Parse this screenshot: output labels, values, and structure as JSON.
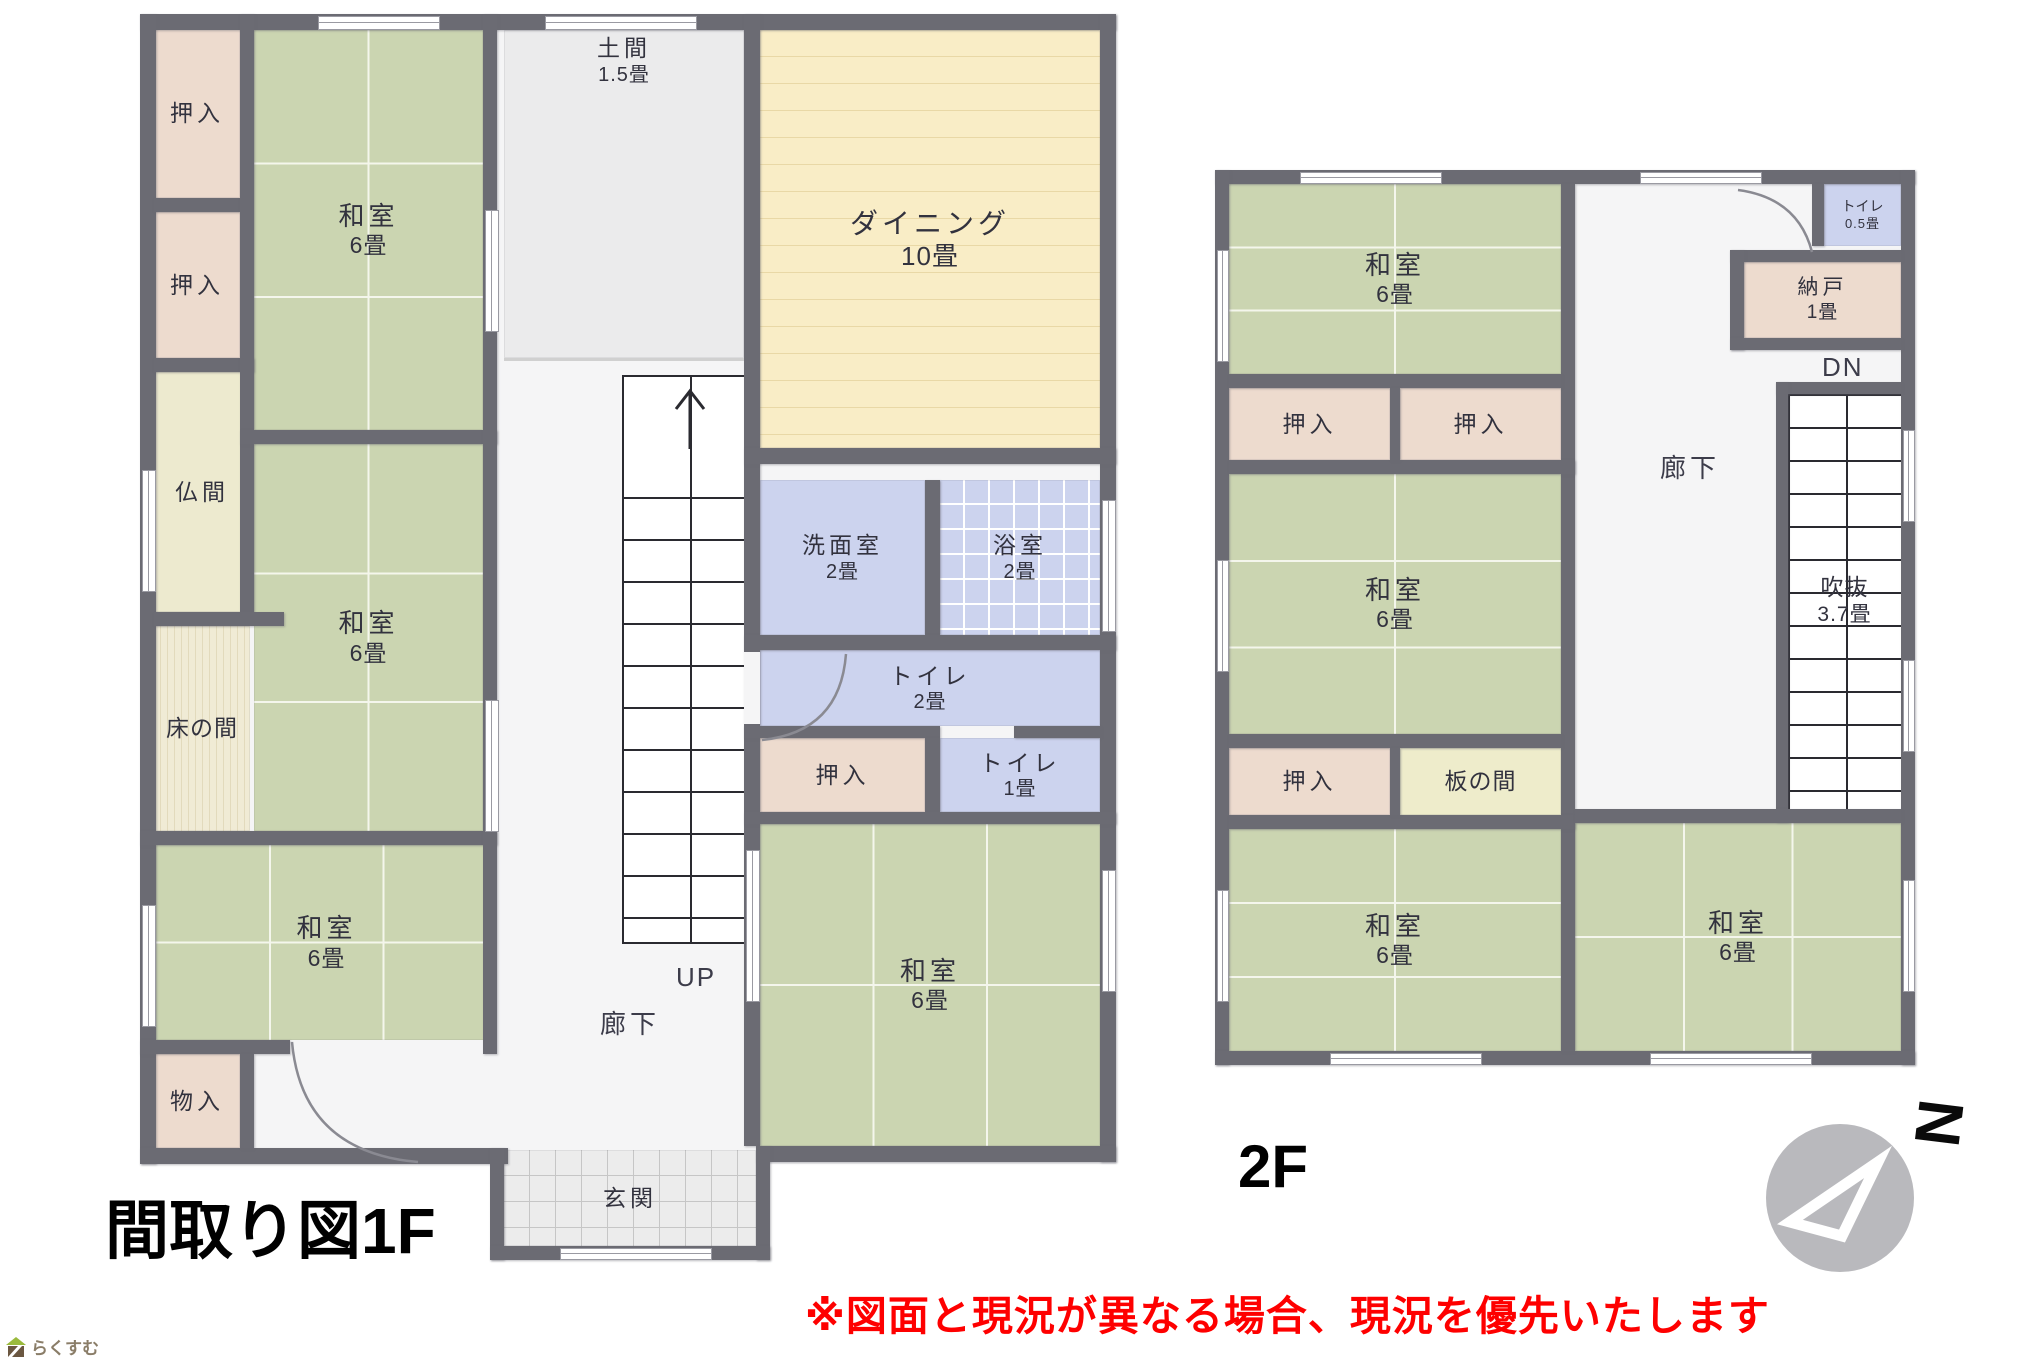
{
  "page": {
    "floor1_title": "間取り図1F",
    "floor2_title": "2F",
    "note": "※図面と現況が異なる場合、現況を優先いたします",
    "logo_text": "らくすむ",
    "compass_letter": "N"
  },
  "floor1": {
    "rooms": [
      {
        "name": "押入",
        "size": ""
      },
      {
        "name": "押入",
        "size": ""
      },
      {
        "name": "仏間",
        "size": ""
      },
      {
        "name": "床の間",
        "size": ""
      },
      {
        "name": "和室",
        "size": "6畳"
      },
      {
        "name": "和室",
        "size": "6畳"
      },
      {
        "name": "和室",
        "size": "6畳"
      },
      {
        "name": "物入",
        "size": ""
      },
      {
        "name": "土間",
        "size": "1.5畳"
      },
      {
        "name": "ダイニング",
        "size": "10畳"
      },
      {
        "name": "洗面室",
        "size": "2畳"
      },
      {
        "name": "浴室",
        "size": "2畳"
      },
      {
        "name": "トイレ",
        "size": "2畳"
      },
      {
        "name": "押入",
        "size": ""
      },
      {
        "name": "トイレ",
        "size": "1畳"
      },
      {
        "name": "和室",
        "size": "6畳"
      },
      {
        "name": "玄関",
        "size": ""
      }
    ],
    "corridor_label": "廊下",
    "up_label": "UP"
  },
  "floor2": {
    "rooms": [
      {
        "name": "和室",
        "size": "6畳"
      },
      {
        "name": "押入",
        "size": ""
      },
      {
        "name": "押入",
        "size": ""
      },
      {
        "name": "和室",
        "size": "6畳"
      },
      {
        "name": "押入",
        "size": ""
      },
      {
        "name": "板の間",
        "size": ""
      },
      {
        "name": "和室",
        "size": "6畳"
      },
      {
        "name": "トイレ",
        "size": "0.5畳"
      },
      {
        "name": "納戸",
        "size": "1畳"
      },
      {
        "name": "吹抜",
        "size": "3.7畳"
      },
      {
        "name": "和室",
        "size": "6畳"
      }
    ],
    "corridor_label": "廊下",
    "dn_label": "DN"
  }
}
